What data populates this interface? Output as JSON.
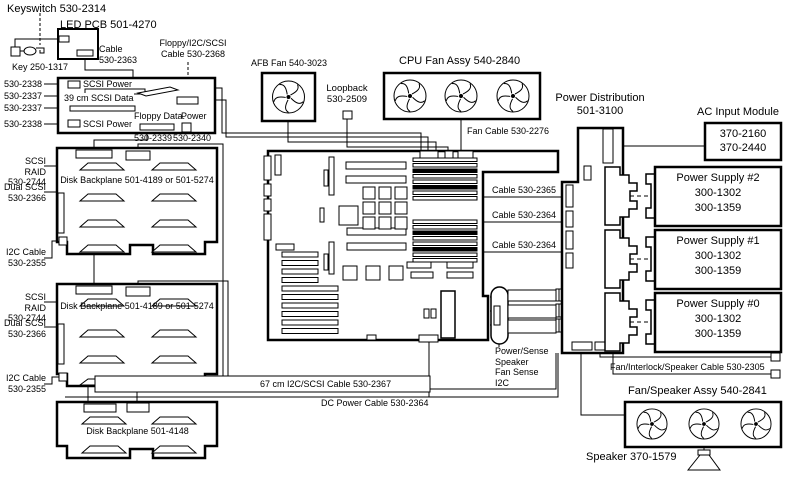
{
  "diagram": {
    "colors": {
      "background": "#ffffff",
      "line": "#000000"
    },
    "top_left": {
      "keyswitch": "Keyswitch 530-2314",
      "led_pcb": "LED PCB 501-4270",
      "key": "Key 250-1317",
      "cable_2363": "Cable\n530-2363",
      "floppy_cable": "Floppy/I2C/SCSI\nCable 530-2368",
      "io_left_labels": [
        "530-2338",
        "530-2337",
        "530-2337",
        "530-2338"
      ],
      "scsi_power_top": "SCSI Power",
      "scsi_data": "39 cm SCSI Data",
      "scsi_power_bottom": "SCSI Power",
      "floppy_data": "Floppy Data.",
      "power": "Power",
      "floppy_conn": "530-2339",
      "power_conn": "530-2340"
    },
    "fans": {
      "afb": "AFB Fan 540-3023",
      "loopback": "Loopback\n530-2509",
      "cpu_assy": "CPU Fan Assy 540-2840",
      "fan_cable": "Fan Cable 530-2276"
    },
    "backplanes": {
      "bp1": {
        "name": "Disk Backplane 501-4189 or 501-5274",
        "scsi_raid": "SCSI RAID\n530-2744",
        "dual_scsi": "Dual SCSI\n530-2366",
        "i2c": "I2C Cable\n530-2355"
      },
      "bp2": {
        "name": "Disk Backplane 501-4189 or 501-5274",
        "scsi_raid": "SCSI RAID\n530-2744",
        "dual_scsi": "Dual SCSI\n530-2366",
        "i2c": "I2C Cable\n530-2355"
      },
      "bp3": {
        "name": "Disk Backplane 501-4148"
      }
    },
    "cables": {
      "c2365": "Cable 530-2365",
      "c2364_a": "Cable 530-2364",
      "c2364_b": "Cable 530-2364",
      "power_sense": "Power/Sense\nSpeaker\nFan Sense\nI2C",
      "c67": "67 cm I2C/SCSI Cable 530-2367",
      "dc": "DC Power Cable 530-2364",
      "fan_interlock": "Fan/Interlock/Speaker Cable 530-2305"
    },
    "power": {
      "distribution": "Power Distribution\n501-3100",
      "ac_module": "AC Input Module",
      "ac_parts": "370-2160\n370-2440",
      "supplies": [
        {
          "title": "Power Supply #2",
          "part1": "300-1302",
          "part2": "300-1359"
        },
        {
          "title": "Power Supply #1",
          "part1": "300-1302",
          "part2": "300-1359"
        },
        {
          "title": "Power Supply #0",
          "part1": "300-1302",
          "part2": "300-1359"
        }
      ]
    },
    "bottom_right": {
      "fan_speaker": "Fan/Speaker Assy 540-2841",
      "speaker": "Speaker 370-1579"
    }
  }
}
